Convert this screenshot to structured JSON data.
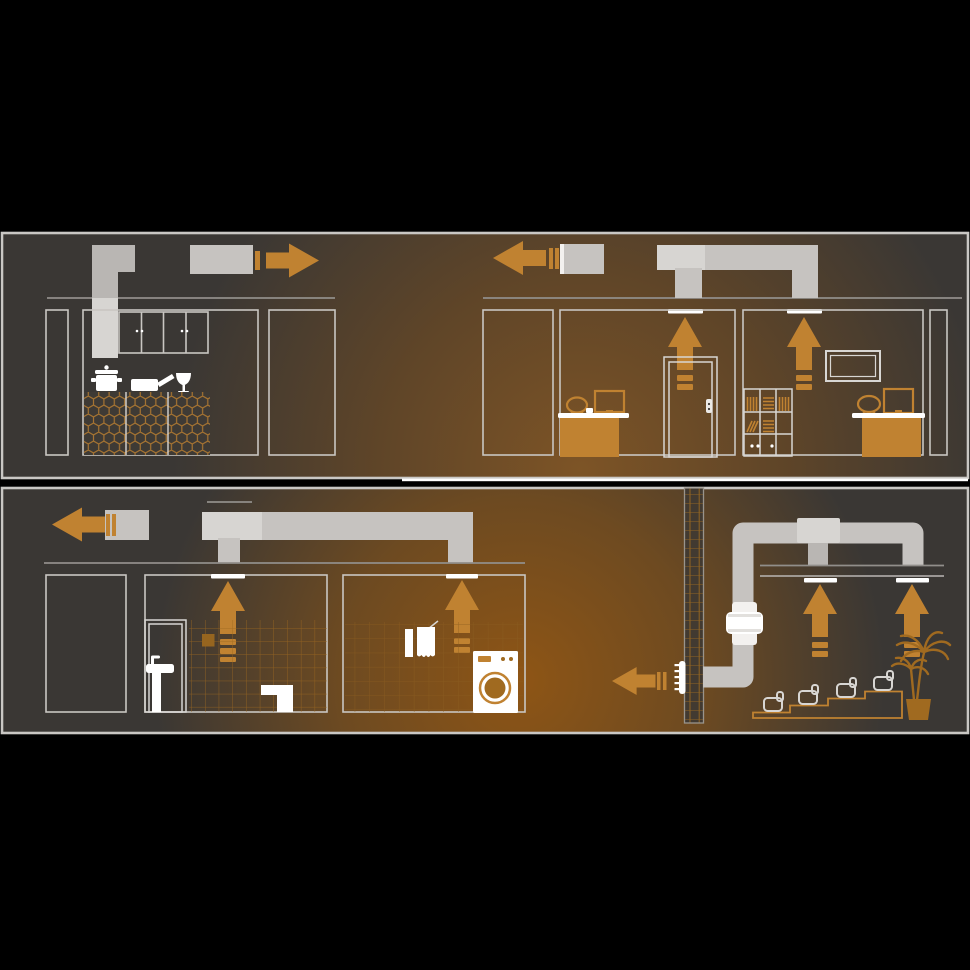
{
  "scene": {
    "description": "duct-ventilation-scheme-cross-sections",
    "panels": [
      {
        "name": "upper-cross-section",
        "rooms": [
          "kitchen",
          "office-with-door",
          "office-with-tv"
        ]
      },
      {
        "name": "lower-cross-section",
        "rooms": [
          "hallway",
          "bathroom",
          "laundry",
          "home-cinema"
        ]
      }
    ]
  },
  "airflow": {
    "extract_up_arrows": 6,
    "exhaust_arrows_left": 3,
    "exhaust_arrows_right": 1,
    "ceiling_vents": 6,
    "inline_duct_fans": 1
  },
  "icons": [
    "cooking-pot",
    "frying-pan",
    "wine-glass",
    "cooker-hood-duct",
    "wall-cabinets",
    "honeycomb-counter",
    "office-desk",
    "office-chair",
    "monitor",
    "door",
    "bookshelf",
    "wall-tv",
    "washbasin",
    "toilet",
    "towels",
    "washing-machine",
    "inline-duct-fan",
    "wall-grille",
    "cinema-seat",
    "palm-plant",
    "duct-shaft"
  ],
  "colors": {
    "bg": "#000000",
    "panel_border": "#c9c7c4",
    "panel_base": "#3a3734",
    "glow_top_hot": "#7d5426",
    "glow_top_mid": "#5f4528",
    "glow_top_edge": "#3a3734",
    "glow_bot_hot": "#8e5515",
    "glow_bot_mid": "#6d4a21",
    "glow_bot_edge": "#3a3734",
    "accent": "#c08231",
    "accent_dim": "#a06a20",
    "duct": "#c6c3c0",
    "duct_dark": "#b9b6b3",
    "duct_light": "#d7d5d2",
    "white": "#ffffff",
    "outline": "#c9c6c2",
    "ceiling": "#918e8a",
    "tile_line": "#9c6820",
    "tile_line_light": "#8a5c20",
    "seat_line": "#d8d6d3"
  }
}
